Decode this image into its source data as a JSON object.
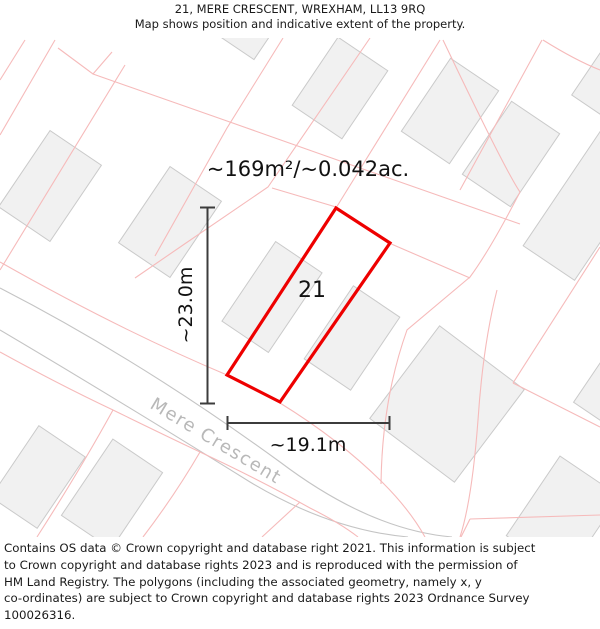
{
  "header": {
    "title": "21, MERE CRESCENT, WREXHAM, LL13 9RQ",
    "subtitle": "Map shows position and indicative extent of the property."
  },
  "map": {
    "area_label": "~169m²/~0.042ac.",
    "plot": {
      "number": "21",
      "polygon_points": "336,208 390,243 280,402 227,375"
    },
    "dimensions": {
      "vertical_label": "~23.0m",
      "horizontal_label": "~19.1m"
    },
    "street": {
      "name": "Mere Crescent"
    },
    "colors": {
      "plot_outline": "#ee0000",
      "parcel_line": "#f6baba",
      "building_fill": "#f1f1f1",
      "building_stroke": "#cacaca",
      "road_line": "#c4c4c4",
      "street_text": "#b8b8b8",
      "dimension_line": "#3c3c3c"
    }
  },
  "footer": {
    "lines": [
      "Contains OS data © Crown copyright and database right 2021. This information is subject",
      "to Crown copyright and database rights 2023 and is reproduced with the permission of",
      "HM Land Registry. The polygons (including the associated geometry, namely x, y",
      "co-ordinates) are subject to Crown copyright and database rights 2023 Ordnance Survey",
      "100026316."
    ]
  }
}
